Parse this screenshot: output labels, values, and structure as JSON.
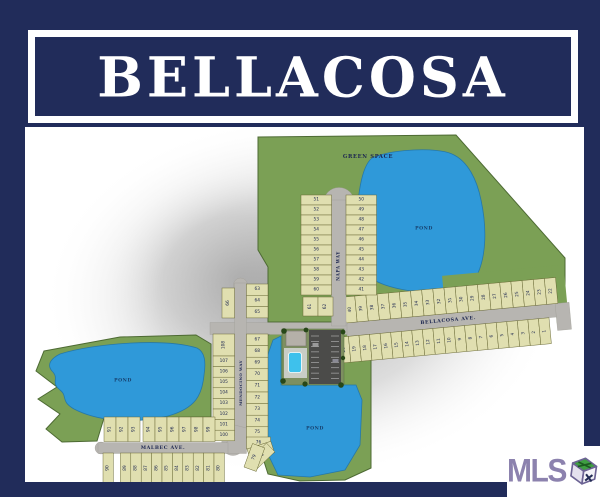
{
  "title": "BELLACOSA",
  "colors": {
    "navy": "#212c5a",
    "green": "#7ba055",
    "pond_blue": "#2f99d9",
    "lot_tan": "#e0dfb0",
    "street_gray": "#b7b5b1",
    "mls_purple": "#8c82ae"
  },
  "map": {
    "labels": {
      "green_space": "GREEN SPACE",
      "pond": "POND"
    },
    "streets": {
      "bellacosa": "BELLACOSA AVE.",
      "malbec": "MALBEC AVE.",
      "napa": "NAPA WAY",
      "mendocino": "MENDOCINO WAY"
    },
    "lot_groups": {
      "napa_west": [
        51,
        52,
        53,
        54,
        55,
        56,
        57,
        58,
        59,
        60
      ],
      "napa_east": [
        50,
        49,
        48,
        47,
        46,
        45,
        44,
        43,
        42,
        41
      ],
      "bellacosa_infill": [
        61,
        62
      ],
      "bellacosa_north": [
        40,
        39,
        38,
        37,
        36,
        35,
        34,
        33,
        32,
        31,
        30,
        29,
        28,
        27,
        26,
        25,
        24,
        23,
        22
      ],
      "bellacosa_south": [
        21,
        20,
        19,
        18,
        17,
        16,
        15,
        14,
        13,
        12,
        11,
        10,
        9,
        8,
        7,
        6,
        5,
        4,
        3,
        2,
        1
      ],
      "mendocino_ne": [
        63,
        64,
        65
      ],
      "mendocino_nw": [
        66
      ],
      "mendocino_se": [
        67,
        68,
        69,
        70,
        71,
        72,
        73,
        74,
        75
      ],
      "bend": [
        76,
        77,
        78,
        79
      ],
      "mendocino_w_tall": [
        108
      ],
      "mendocino_w": [
        107,
        106,
        105,
        104,
        103,
        102,
        101,
        100
      ],
      "malbec_north": [
        91,
        92,
        93,
        94,
        95,
        96,
        97,
        98,
        99
      ],
      "malbec_south": [
        90,
        89,
        88,
        87,
        86,
        85,
        84,
        83,
        82,
        81,
        80
      ]
    }
  },
  "logo": {
    "text": "MLS"
  }
}
